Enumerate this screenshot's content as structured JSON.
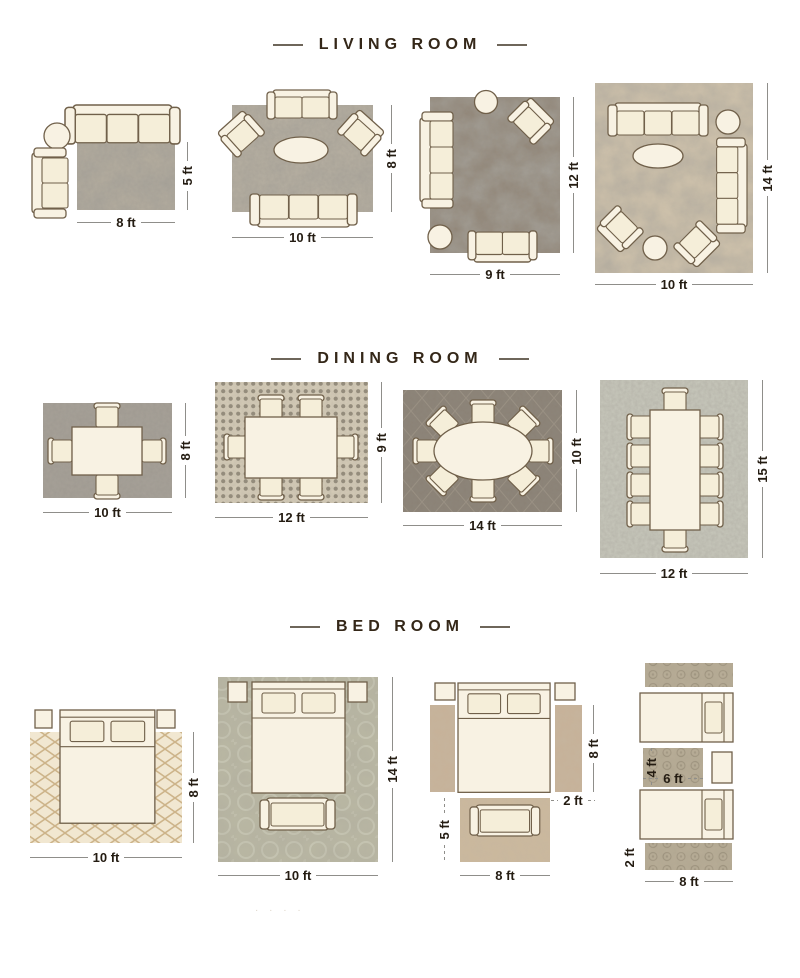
{
  "colors": {
    "background": "#ffffff",
    "heading_text": "#342718",
    "heading_dash": "#6e665a",
    "dimension_text": "#241c12",
    "dimension_line": "#8f8e8a",
    "furniture_fill": "#f8f2e3",
    "furniture_outline": "#70604a",
    "rug_gray": "#b3ac9e",
    "rug_dark": "#93887a",
    "rug_beige": "#cdc1ab",
    "rug_mosaic": "#d3cab6",
    "rug_sage": "#c6c6ba",
    "rug_cream": "#f1e7d1",
    "rug_damask_sage": "#b9b7a3",
    "rug_tan": "#c9b69b",
    "rug_ornate": "#b2a892"
  },
  "watermark": "· · · ·",
  "sections": [
    {
      "title": "LIVING ROOM",
      "layouts": [
        {
          "labels": {
            "bottom": "8 ft",
            "side": "5 ft"
          },
          "furniture": [
            "sofa",
            "round-side-table",
            "loveseat",
            "rug"
          ]
        },
        {
          "labels": {
            "bottom": "10 ft",
            "side": "8 ft"
          },
          "furniture": [
            "sofa",
            "armchair",
            "armchair",
            "oval-coffee-table",
            "sofa",
            "rug"
          ]
        },
        {
          "labels": {
            "bottom": "9 ft",
            "side": "12 ft"
          },
          "furniture": [
            "round-side-table",
            "armchair",
            "sofa",
            "round-ottoman",
            "sofa",
            "rug"
          ]
        },
        {
          "labels": {
            "bottom": "10 ft",
            "side": "14 ft"
          },
          "furniture": [
            "sofa",
            "round-side-table",
            "oval-coffee-table",
            "sofa",
            "armchair",
            "armchair",
            "round-ottoman",
            "rug"
          ]
        }
      ]
    },
    {
      "title": "DINING ROOM",
      "layouts": [
        {
          "labels": {
            "bottom": "10 ft",
            "side": "8 ft"
          },
          "furniture": [
            "dining-table",
            "chair-x4",
            "rug"
          ]
        },
        {
          "labels": {
            "bottom": "12 ft",
            "side": "9 ft"
          },
          "furniture": [
            "dining-table",
            "chair-x6",
            "rug"
          ]
        },
        {
          "labels": {
            "bottom": "14 ft",
            "side": "10 ft"
          },
          "furniture": [
            "oval-dining-table",
            "chair-x8",
            "rug"
          ]
        },
        {
          "labels": {
            "bottom": "12 ft",
            "side": "15 ft"
          },
          "furniture": [
            "dining-table",
            "chair-x10",
            "rug"
          ]
        }
      ]
    },
    {
      "title": "BED ROOM",
      "layouts": [
        {
          "labels": {
            "bottom": "10 ft",
            "side": "8 ft"
          },
          "furniture": [
            "nightstand",
            "bed",
            "nightstand",
            "rug"
          ]
        },
        {
          "labels": {
            "bottom": "10 ft",
            "side": "14 ft"
          },
          "furniture": [
            "nightstand",
            "bed",
            "nightstand",
            "bench",
            "rug"
          ]
        },
        {
          "labels": {
            "bottom": "8 ft",
            "side": "8 ft",
            "runner_width": "2 ft",
            "foot_height": "5 ft"
          },
          "furniture": [
            "nightstand",
            "bed",
            "nightstand",
            "runner-rug",
            "runner-rug",
            "bench",
            "foot-rug"
          ]
        },
        {
          "labels": {
            "bottom": "8 ft",
            "runner_height": "2 ft",
            "mid_height": "4 ft",
            "mid_width": "6 ft"
          },
          "furniture": [
            "runner-rug",
            "bed",
            "accent-rug",
            "nightstand",
            "bed",
            "runner-rug"
          ]
        }
      ]
    }
  ]
}
